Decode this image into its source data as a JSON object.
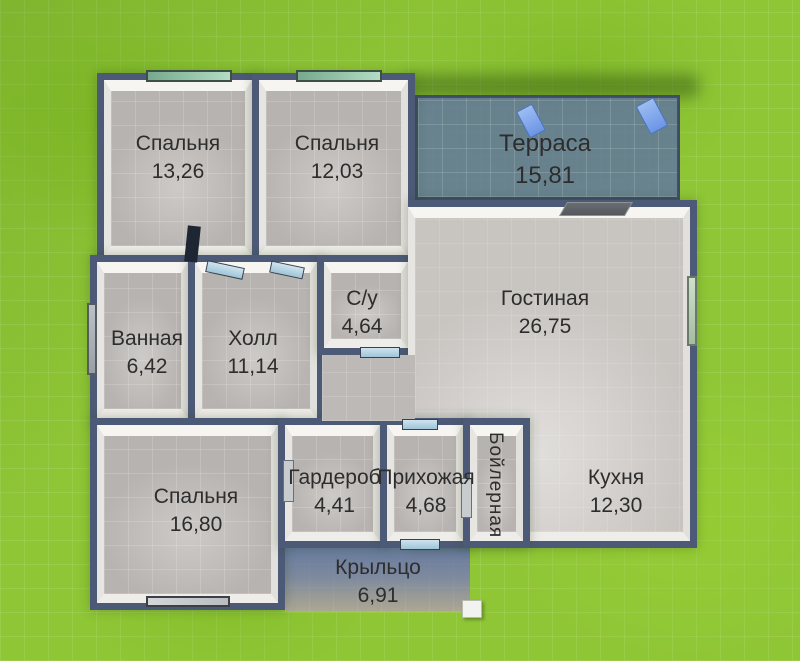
{
  "scene": "house-floor-plan",
  "colors": {
    "wall": "#4d5a77",
    "floor": "#b7b3b0",
    "floor_light": "#c8c4c0",
    "grass": "#8fc636",
    "terrace_overlay": "#62779e",
    "porch_sand": "#c8ba96",
    "label_text": "#2d2d2d",
    "window_glass": "#9fceb4",
    "door_glass": "#9fc4d8"
  },
  "rooms": [
    {
      "id": "bedroom-1",
      "name": "Спальня",
      "area": "13,26"
    },
    {
      "id": "bedroom-2",
      "name": "Спальня",
      "area": "12,03"
    },
    {
      "id": "terrace",
      "name": "Терраса",
      "area": "15,81"
    },
    {
      "id": "bathroom",
      "name": "Ванная",
      "area": "6,42"
    },
    {
      "id": "hall",
      "name": "Холл",
      "area": "11,14"
    },
    {
      "id": "wc",
      "name": "С/у",
      "area": "4,64"
    },
    {
      "id": "living-room",
      "name": "Гостиная",
      "area": "26,75"
    },
    {
      "id": "bedroom-3",
      "name": "Спальня",
      "area": "16,80"
    },
    {
      "id": "wardrobe",
      "name": "Гардероб",
      "area": "4,41"
    },
    {
      "id": "entry-hall",
      "name": "Прихожая",
      "area": "4,68"
    },
    {
      "id": "boiler-room",
      "name": "Бойлерная"
    },
    {
      "id": "kitchen",
      "name": "Кухня",
      "area": "12,30"
    },
    {
      "id": "porch",
      "name": "Крыльцо",
      "area": "6,91"
    }
  ]
}
